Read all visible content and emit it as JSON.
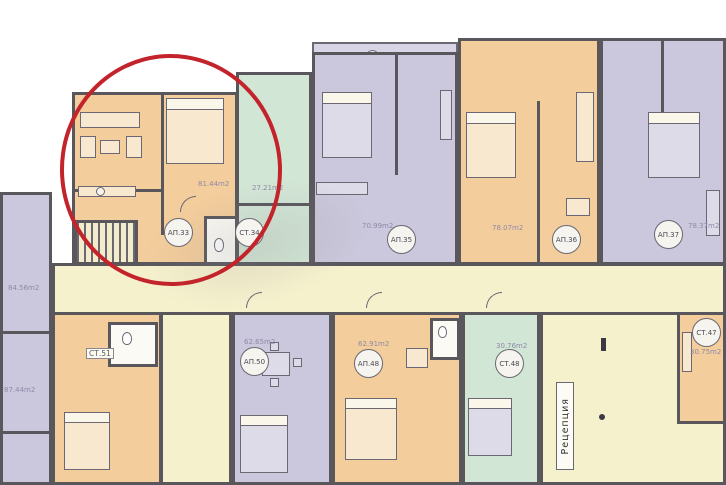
{
  "plan": {
    "reception_label": "Рецепция",
    "highlight_color": "#c3242b",
    "colors": {
      "wall": "#59565c",
      "orange_room": "#f4cd9c",
      "lavender_room": "#cbc7dc",
      "green_room": "#d2e6d6",
      "corridor_yellow": "#f6f1cd"
    },
    "units": {
      "ap33": {
        "id": "АП.33",
        "area": "81.44m2"
      },
      "st34": {
        "id": "СТ.34",
        "area": "27.21m2"
      },
      "ap35": {
        "id": "АП.35",
        "area": "70.99m2"
      },
      "ap36": {
        "id": "АП.36",
        "area": "78.07m2"
      },
      "ap37": {
        "id": "АП.37",
        "area": "78.37m2"
      },
      "left_upper": {
        "area": "84.56m2"
      },
      "left_lower": {
        "area": "87.44m2"
      },
      "st51": {
        "id": "СТ.51"
      },
      "ap50": {
        "id": "АП.50",
        "area": "62.65m2"
      },
      "ap48": {
        "id": "АП.48",
        "area": "62.91m2"
      },
      "st48": {
        "id": "СТ.48",
        "area": "30.76m2"
      },
      "st47": {
        "id": "СТ.47",
        "area": "30.75m2"
      }
    }
  }
}
